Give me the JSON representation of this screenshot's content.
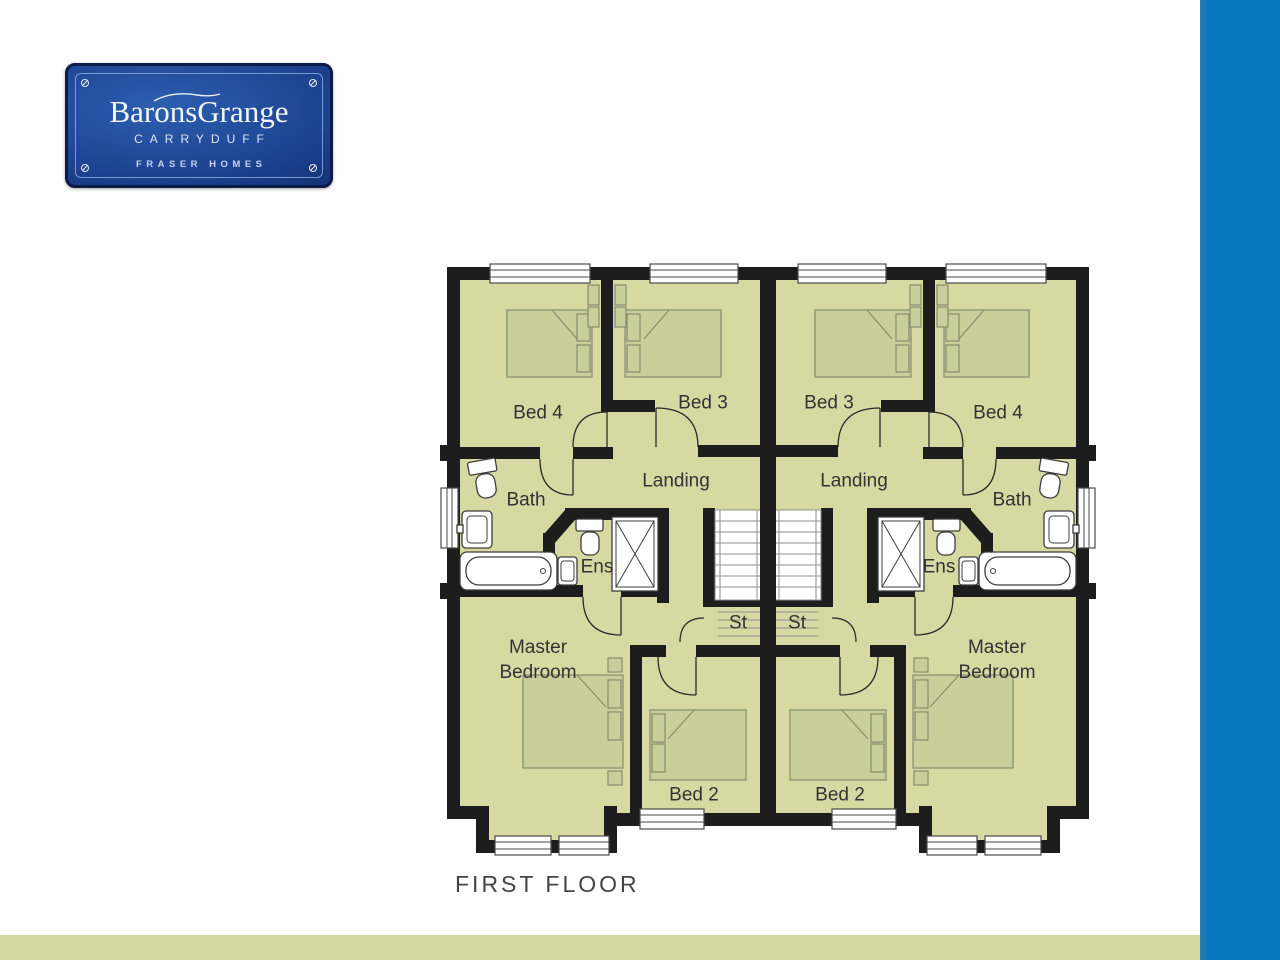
{
  "brand_plaque": {
    "title": "BaronsGrange",
    "subtitle": "CARRYDUFF",
    "tagline": "FRASER HOMES"
  },
  "floor_plan": {
    "caption": "FIRST FLOOR",
    "rooms": {
      "bed4": "Bed 4",
      "bed3": "Bed 3",
      "landing": "Landing",
      "bath": "Bath",
      "ens": "Ens",
      "store": "St",
      "master_line1": "Master",
      "master_line2": "Bedroom",
      "bed2": "Bed 2"
    }
  },
  "colors": {
    "accent_blue": "#0879c1",
    "stripe_olive": "#d5d7a0",
    "floor_olive": "#d7d9a3",
    "wall_black": "#1d1d1d",
    "label_ink": "#333333"
  }
}
